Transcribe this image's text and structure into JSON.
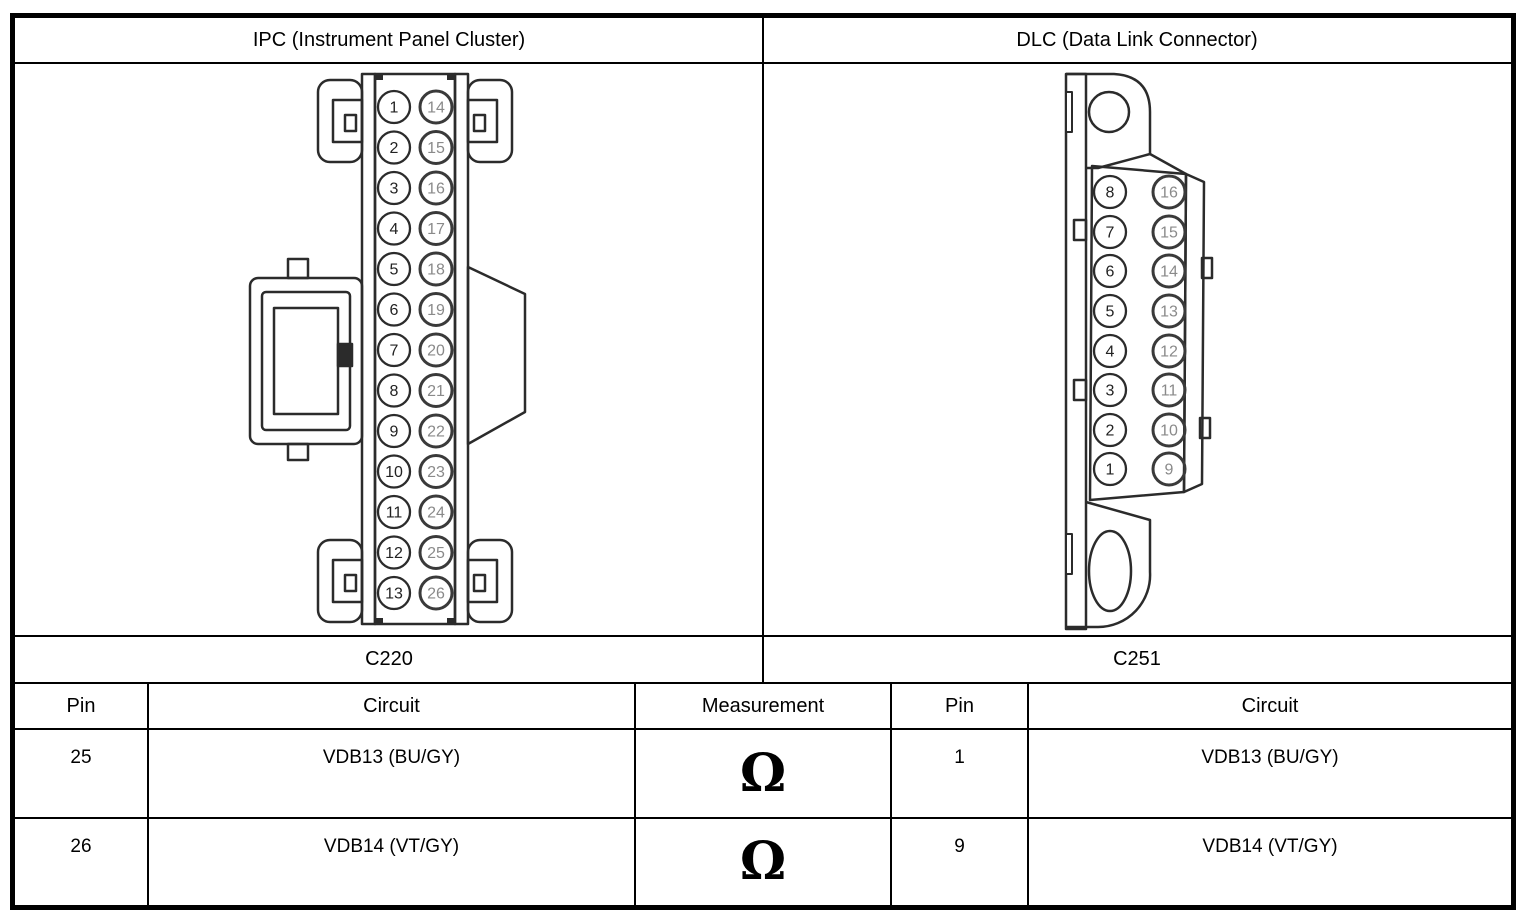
{
  "title_row": {
    "ipc": "IPC (Instrument Panel Cluster)",
    "dlc": "DLC (Data Link Connector)"
  },
  "connectors": {
    "ipc": {
      "label": "C220",
      "pins_left": [
        "1",
        "2",
        "3",
        "4",
        "5",
        "6",
        "7",
        "8",
        "9",
        "10",
        "11",
        "12",
        "13"
      ],
      "pins_right": [
        "14",
        "15",
        "16",
        "17",
        "18",
        "19",
        "20",
        "21",
        "22",
        "23",
        "24",
        "25",
        "26"
      ]
    },
    "dlc": {
      "label": "C251",
      "pins_left": [
        "8",
        "7",
        "6",
        "5",
        "4",
        "3",
        "2",
        "1"
      ],
      "pins_right": [
        "16",
        "15",
        "14",
        "13",
        "12",
        "11",
        "10",
        "9"
      ]
    }
  },
  "table": {
    "headers": {
      "pin_ipc": "Pin",
      "circuit_ipc": "Circuit",
      "measurement": "Measurement",
      "pin_dlc": "Pin",
      "circuit_dlc": "Circuit"
    },
    "rows": [
      {
        "ipc_pin": "25",
        "ipc_circuit": "VDB13 (BU/GY)",
        "measurement": "Ω",
        "dlc_pin": "1",
        "dlc_circuit": "VDB13 (BU/GY)"
      },
      {
        "ipc_pin": "26",
        "ipc_circuit": "VDB14 (VT/GY)",
        "measurement": "Ω",
        "dlc_pin": "9",
        "dlc_circuit": "VDB14 (VT/GY)"
      }
    ]
  },
  "colors": {
    "line": "#2b2b2b",
    "pin_number_near": "#222222",
    "pin_number_far": "#8a8a8a",
    "border": "#000000",
    "background": "#ffffff"
  }
}
